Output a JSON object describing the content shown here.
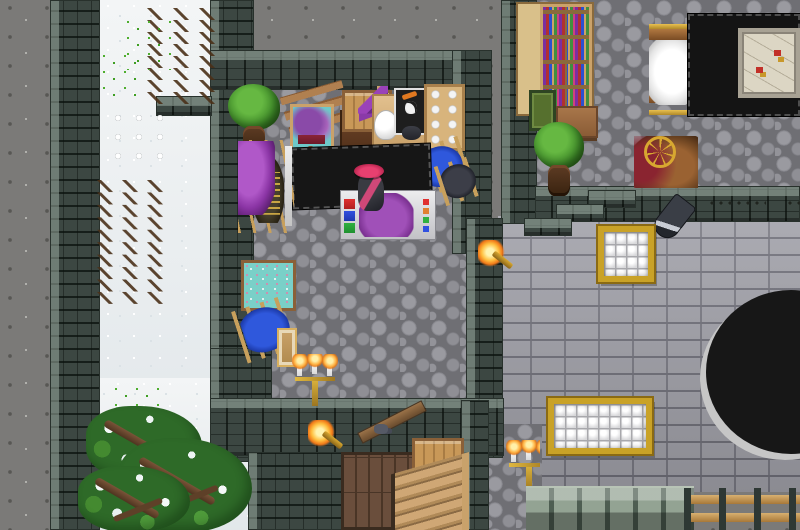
{
  "meta": {
    "description": "Top-down 2D fantasy RPG town scene: a tailor-dyer workshop with stone walls, a snowy path outside, a neighboring room with bookcase and map table, a gray-brick building facade with lattice windows, a wooden staircase room, and snow-covered evergreens",
    "view": "overhead tile view",
    "canvas": {
      "width": 800,
      "height": 530
    }
  },
  "palette": {
    "rock": "#7b7a78",
    "snow": "#edf0f1",
    "wall_stone": "#3c4742",
    "cobble_floor": "#8f8f95",
    "brick_facade": "#a2a2aa",
    "wood": "#c89858",
    "dark_table": "#161616",
    "purple_cloth": "#8a34a4",
    "blue_cloth": "#2f58dc",
    "flame": "#ffb040",
    "gold_trim": "#c9a227",
    "tree_green": "#3e8a28",
    "hat_pink": "#e84070"
  },
  "scene": {
    "terrain": [
      {
        "name": "rock-ground",
        "sprite": "s-rock",
        "x": 0,
        "y": 0,
        "w": 800,
        "h": 530,
        "interactable": true
      },
      {
        "name": "snow-path",
        "sprite": "s-snow",
        "x": 100,
        "y": 0,
        "w": 114,
        "h": 462,
        "interactable": true
      },
      {
        "name": "snow-ground-south",
        "sprite": "s-snow",
        "x": 84,
        "y": 378,
        "w": 168,
        "h": 152,
        "interactable": true
      },
      {
        "name": "shop-cobblestone-floor",
        "sprite": "s-cobble",
        "x": 250,
        "y": 86,
        "w": 218,
        "h": 318,
        "interactable": true
      },
      {
        "name": "northeast-room-cobblestone-floor",
        "sprite": "s-cobble",
        "x": 535,
        "y": 0,
        "w": 265,
        "h": 192,
        "interactable": true
      },
      {
        "name": "brick-building-facade",
        "sprite": "s-brick",
        "x": 498,
        "y": 216,
        "w": 302,
        "h": 276,
        "interactable": false
      },
      {
        "name": "stair-room-interior",
        "sprite": "s-darkfill",
        "x": 248,
        "y": 452,
        "w": 255,
        "h": 78,
        "interactable": false
      },
      {
        "name": "cobblestone-patch-southeast",
        "sprite": "s-cobble",
        "x": 486,
        "y": 424,
        "w": 56,
        "h": 106,
        "interactable": true
      }
    ],
    "walls": [
      {
        "name": "outer-wall-west",
        "sprite": "s-wallv",
        "x": 50,
        "y": 0,
        "w": 50,
        "h": 530,
        "interactable": false
      },
      {
        "name": "shop-wall-west",
        "sprite": "s-wallv",
        "x": 210,
        "y": 0,
        "w": 44,
        "h": 462,
        "interactable": false
      },
      {
        "name": "wall-jut-west",
        "sprite": "s-wallh",
        "x": 156,
        "y": 96,
        "w": 56,
        "h": 20,
        "interactable": false
      },
      {
        "name": "shop-wall-north",
        "sprite": "s-wallh",
        "x": 210,
        "y": 50,
        "w": 272,
        "h": 40,
        "interactable": false
      },
      {
        "name": "shop-wall-east",
        "sprite": "s-wallv",
        "x": 452,
        "y": 50,
        "w": 40,
        "h": 204,
        "interactable": false
      },
      {
        "name": "divider-wall-northeast",
        "sprite": "s-wallv",
        "x": 501,
        "y": 0,
        "w": 36,
        "h": 224,
        "interactable": false
      },
      {
        "name": "northeast-room-wall-south",
        "sprite": "s-wallh",
        "x": 535,
        "y": 186,
        "w": 265,
        "h": 36,
        "interactable": false
      },
      {
        "name": "facade-wall-left",
        "sprite": "s-wallv",
        "x": 466,
        "y": 218,
        "w": 37,
        "h": 240,
        "interactable": false
      },
      {
        "name": "shop-wall-west-lower",
        "sprite": "s-wallv",
        "x": 210,
        "y": 348,
        "w": 62,
        "h": 110,
        "interactable": false
      },
      {
        "name": "lower-building-wall-north",
        "sprite": "s-wallh",
        "x": 210,
        "y": 398,
        "w": 294,
        "h": 58,
        "interactable": false
      },
      {
        "name": "stair-room-wall-east",
        "sprite": "s-wallv",
        "x": 461,
        "y": 400,
        "w": 28,
        "h": 130,
        "interactable": false
      },
      {
        "name": "stair-room-wall-west-fill",
        "sprite": "s-wallv",
        "x": 248,
        "y": 452,
        "w": 96,
        "h": 78,
        "interactable": false
      },
      {
        "name": "facade-step-block-high",
        "sprite": "s-wallh",
        "x": 588,
        "y": 190,
        "w": 48,
        "h": 18,
        "interactable": false
      },
      {
        "name": "facade-step-block-mid",
        "sprite": "s-wallh",
        "x": 556,
        "y": 204,
        "w": 48,
        "h": 18,
        "interactable": false
      },
      {
        "name": "facade-step-block-low",
        "sprite": "s-wallh",
        "x": 524,
        "y": 218,
        "w": 48,
        "h": 18,
        "interactable": false
      }
    ],
    "objects": [
      {
        "name": "bookcase-with-books",
        "sprite": "s-bookcase",
        "x": 516,
        "y": 2,
        "w": 78,
        "h": 114,
        "interactable": true
      },
      {
        "name": "green-framed-painting",
        "sprite": "s-paintgreen",
        "x": 529,
        "y": 90,
        "w": 27,
        "h": 41,
        "interactable": true
      },
      {
        "name": "small-side-table",
        "sprite": "s-sidetable",
        "x": 556,
        "y": 106,
        "w": 42,
        "h": 32,
        "interactable": true
      },
      {
        "name": "potted-bush-northeast",
        "sprite": "s-pottree",
        "x": 534,
        "y": 122,
        "w": 50,
        "h": 78,
        "interactable": true
      },
      {
        "name": "upright-loom-white-wool",
        "sprite": "s-loomwhite",
        "x": 649,
        "y": 24,
        "w": 46,
        "h": 96,
        "interactable": true
      },
      {
        "name": "large-black-table",
        "sprite": "s-blacktable",
        "x": 688,
        "y": 14,
        "w": 112,
        "h": 102,
        "interactable": true
      },
      {
        "name": "framed-map",
        "sprite": "s-map",
        "x": 738,
        "y": 28,
        "w": 62,
        "h": 70,
        "interactable": true
      },
      {
        "name": "spinning-wheel",
        "sprite": "s-spinwheel",
        "x": 634,
        "y": 136,
        "w": 64,
        "h": 52,
        "interactable": true
      },
      {
        "name": "hanging-sword",
        "sprite": "s-sword",
        "x": 660,
        "y": 196,
        "w": 26,
        "h": 44,
        "interactable": true
      },
      {
        "name": "wall-chain",
        "sprite": "s-chain",
        "x": 708,
        "y": 198,
        "w": 58,
        "h": 13,
        "interactable": false
      },
      {
        "name": "wall-chain-short",
        "sprite": "s-chain",
        "x": 786,
        "y": 198,
        "w": 14,
        "h": 16,
        "interactable": false
      },
      {
        "name": "potted-tree-shop",
        "sprite": "s-pottree",
        "x": 228,
        "y": 84,
        "w": 52,
        "h": 76,
        "interactable": true
      },
      {
        "name": "wooden-bench",
        "sprite": "s-benchwood",
        "x": 284,
        "y": 88,
        "w": 64,
        "h": 40,
        "interactable": true
      },
      {
        "name": "easel-ship-painting",
        "sprite": "s-easelship",
        "x": 282,
        "y": 102,
        "w": 56,
        "h": 64,
        "interactable": true
      },
      {
        "name": "dresser",
        "sprite": "s-dresser",
        "x": 340,
        "y": 110,
        "w": 54,
        "h": 50,
        "interactable": true
      },
      {
        "name": "crate-on-dresser",
        "sprite": "s-crate",
        "x": 342,
        "y": 90,
        "w": 50,
        "h": 42,
        "interactable": true
      },
      {
        "name": "purple-hat-stand",
        "sprite": "s-hatstand",
        "x": 358,
        "y": 86,
        "w": 38,
        "h": 46,
        "interactable": true
      },
      {
        "name": "work-table",
        "sprite": "s-worktable",
        "x": 372,
        "y": 94,
        "w": 62,
        "h": 58,
        "interactable": true
      },
      {
        "name": "white-jug",
        "sprite": "s-jug",
        "x": 374,
        "y": 110,
        "w": 24,
        "h": 30,
        "interactable": true
      },
      {
        "name": "skull-painting",
        "sprite": "s-skullpaint",
        "x": 394,
        "y": 88,
        "w": 33,
        "h": 47,
        "interactable": true
      },
      {
        "name": "dark-item-on-table",
        "sprite": "s-darkitem",
        "x": 402,
        "y": 126,
        "w": 19,
        "h": 14,
        "interactable": true
      },
      {
        "name": "shelf-with-cloth-bolts",
        "sprite": "s-shelfbolts",
        "x": 424,
        "y": 84,
        "w": 41,
        "h": 67,
        "interactable": true
      },
      {
        "name": "bench-blue-cloth-east",
        "sprite": "s-benchblue",
        "x": 417,
        "y": 142,
        "w": 50,
        "h": 49,
        "interactable": true
      },
      {
        "name": "bench-dark-cloth-east",
        "sprite": "s-benchdark",
        "x": 439,
        "y": 160,
        "w": 40,
        "h": 41,
        "interactable": true
      },
      {
        "name": "black-counter",
        "sprite": "s-counterblack",
        "x": 292,
        "y": 146,
        "w": 139,
        "h": 61,
        "interactable": true
      },
      {
        "name": "wall-loom-purple-cloth",
        "sprite": "s-loompurple",
        "x": 238,
        "y": 140,
        "w": 56,
        "h": 93,
        "interactable": true
      },
      {
        "name": "teal-tapestry-easel",
        "sprite": "s-tapestry",
        "x": 241,
        "y": 260,
        "w": 55,
        "h": 51,
        "interactable": true
      },
      {
        "name": "bench-blue-cloth-west",
        "sprite": "s-benchblue",
        "x": 238,
        "y": 302,
        "w": 57,
        "h": 54,
        "interactable": true
      },
      {
        "name": "small-standing-frame",
        "sprite": "s-framesmall",
        "x": 277,
        "y": 328,
        "w": 20,
        "h": 39,
        "interactable": true
      },
      {
        "name": "dye-tub-table",
        "sprite": "s-dyetable",
        "x": 340,
        "y": 190,
        "w": 96,
        "h": 50,
        "interactable": true
      },
      {
        "name": "player-character",
        "sprite": "s-character",
        "x": 349,
        "y": 164,
        "w": 44,
        "h": 58,
        "interactable": true
      },
      {
        "name": "candelabra-shop",
        "sprite": "s-candelabra",
        "x": 292,
        "y": 354,
        "w": 48,
        "h": 52,
        "interactable": true
      },
      {
        "name": "wall-torch-corner",
        "sprite": "s-torch",
        "x": 478,
        "y": 240,
        "w": 38,
        "h": 50,
        "interactable": true
      },
      {
        "name": "stair-stringer-board",
        "sprite": "s-stringer",
        "x": 356,
        "y": 416,
        "w": 72,
        "h": 12,
        "interactable": true
      },
      {
        "name": "shoes-on-board",
        "sprite": "s-shoes",
        "x": 374,
        "y": 424,
        "w": 14,
        "h": 10,
        "interactable": true
      },
      {
        "name": "wooden-plank-floor",
        "sprite": "s-woodfloor",
        "x": 341,
        "y": 452,
        "w": 80,
        "h": 78,
        "interactable": true
      },
      {
        "name": "crate-stair-room",
        "sprite": "s-crate",
        "x": 412,
        "y": 438,
        "w": 52,
        "h": 36,
        "interactable": true
      },
      {
        "name": "wooden-staircase",
        "sprite": "s-stairs",
        "x": 391,
        "y": 452,
        "w": 78,
        "h": 78,
        "interactable": true
      },
      {
        "name": "wall-torch-lower",
        "sprite": "s-torch",
        "x": 308,
        "y": 420,
        "w": 48,
        "h": 32,
        "interactable": true
      },
      {
        "name": "candelabra-southeast",
        "sprite": "s-candelabra",
        "x": 506,
        "y": 440,
        "w": 34,
        "h": 52,
        "interactable": true
      },
      {
        "name": "lattice-window-upper",
        "sprite": "s-window",
        "x": 598,
        "y": 226,
        "w": 56,
        "h": 56,
        "interactable": true
      },
      {
        "name": "lattice-window-wide",
        "sprite": "s-window",
        "x": 548,
        "y": 398,
        "w": 104,
        "h": 56,
        "interactable": true
      },
      {
        "name": "dark-circular-pit",
        "sprite": "s-blackcircle",
        "x": 700,
        "y": 296,
        "w": 170,
        "h": 164,
        "interactable": false
      },
      {
        "name": "battlement-wall-top",
        "sprite": "s-battlement",
        "x": 526,
        "y": 486,
        "w": 168,
        "h": 44,
        "interactable": false
      },
      {
        "name": "wooden-fence",
        "sprite": "s-fence",
        "x": 684,
        "y": 488,
        "w": 116,
        "h": 42,
        "interactable": false
      },
      {
        "name": "snow-twigs-north",
        "sprite": "s-twigs",
        "x": 146,
        "y": 8,
        "w": 70,
        "h": 96,
        "interactable": false
      },
      {
        "name": "snow-twigs-mid",
        "sprite": "s-twigs",
        "x": 96,
        "y": 180,
        "w": 68,
        "h": 124,
        "interactable": false
      },
      {
        "name": "grass-tufts-north",
        "sprite": "s-tufts",
        "x": 124,
        "y": 18,
        "w": 48,
        "h": 52,
        "interactable": false
      },
      {
        "name": "grass-tufts-west",
        "sprite": "s-tufts",
        "x": 100,
        "y": 52,
        "w": 44,
        "h": 46,
        "interactable": false
      },
      {
        "name": "snowballs-on-path",
        "sprite": "s-snowballs",
        "x": 112,
        "y": 112,
        "w": 56,
        "h": 60,
        "interactable": false
      },
      {
        "name": "grass-tufts-south",
        "sprite": "s-tufts",
        "x": 112,
        "y": 385,
        "w": 52,
        "h": 46,
        "interactable": false
      },
      {
        "name": "snow-covered-tree-north",
        "sprite": "s-snowtree",
        "x": 86,
        "y": 406,
        "w": 116,
        "h": 74,
        "interactable": true
      },
      {
        "name": "snow-covered-tree-east",
        "sprite": "s-snowtree",
        "x": 118,
        "y": 438,
        "w": 134,
        "h": 94,
        "interactable": true
      },
      {
        "name": "snow-covered-tree-south",
        "sprite": "s-snowtree",
        "x": 78,
        "y": 466,
        "w": 112,
        "h": 66,
        "interactable": true
      }
    ]
  }
}
